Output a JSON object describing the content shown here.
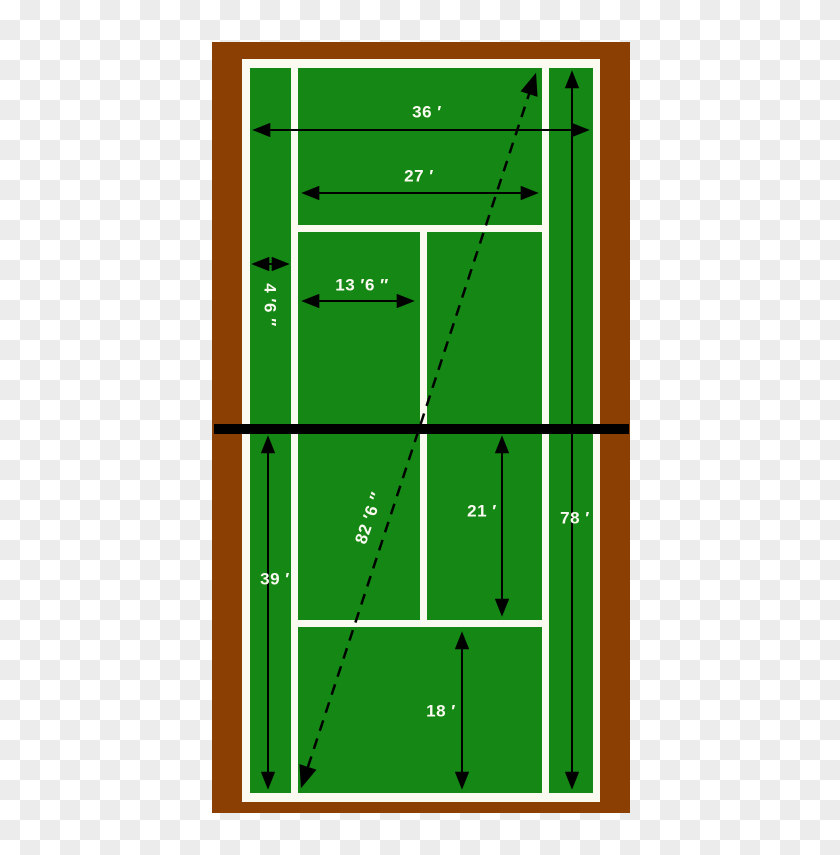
{
  "diagram": {
    "title": "Tennis court dimensions diagram",
    "type": "tennis-court-dimension-drawing"
  },
  "labels": {
    "overall_width": "36 ′",
    "singles_width": "27 ′",
    "alley_width": "4 ′6 ″",
    "service_box_width": "13 ′6 ″",
    "diagonal": "82 ′6 ″",
    "service_depth": "21 ′",
    "court_length": "78 ′",
    "half_court": "39 ′",
    "backcourt_depth": "18 ′"
  },
  "colors": {
    "court_green": "#148714",
    "border_brown": "#8C3F03",
    "line_white": "#FAFAF0",
    "net_black": "#000000",
    "checker_white": "#ffffff",
    "checker_gray": "#ececec"
  }
}
